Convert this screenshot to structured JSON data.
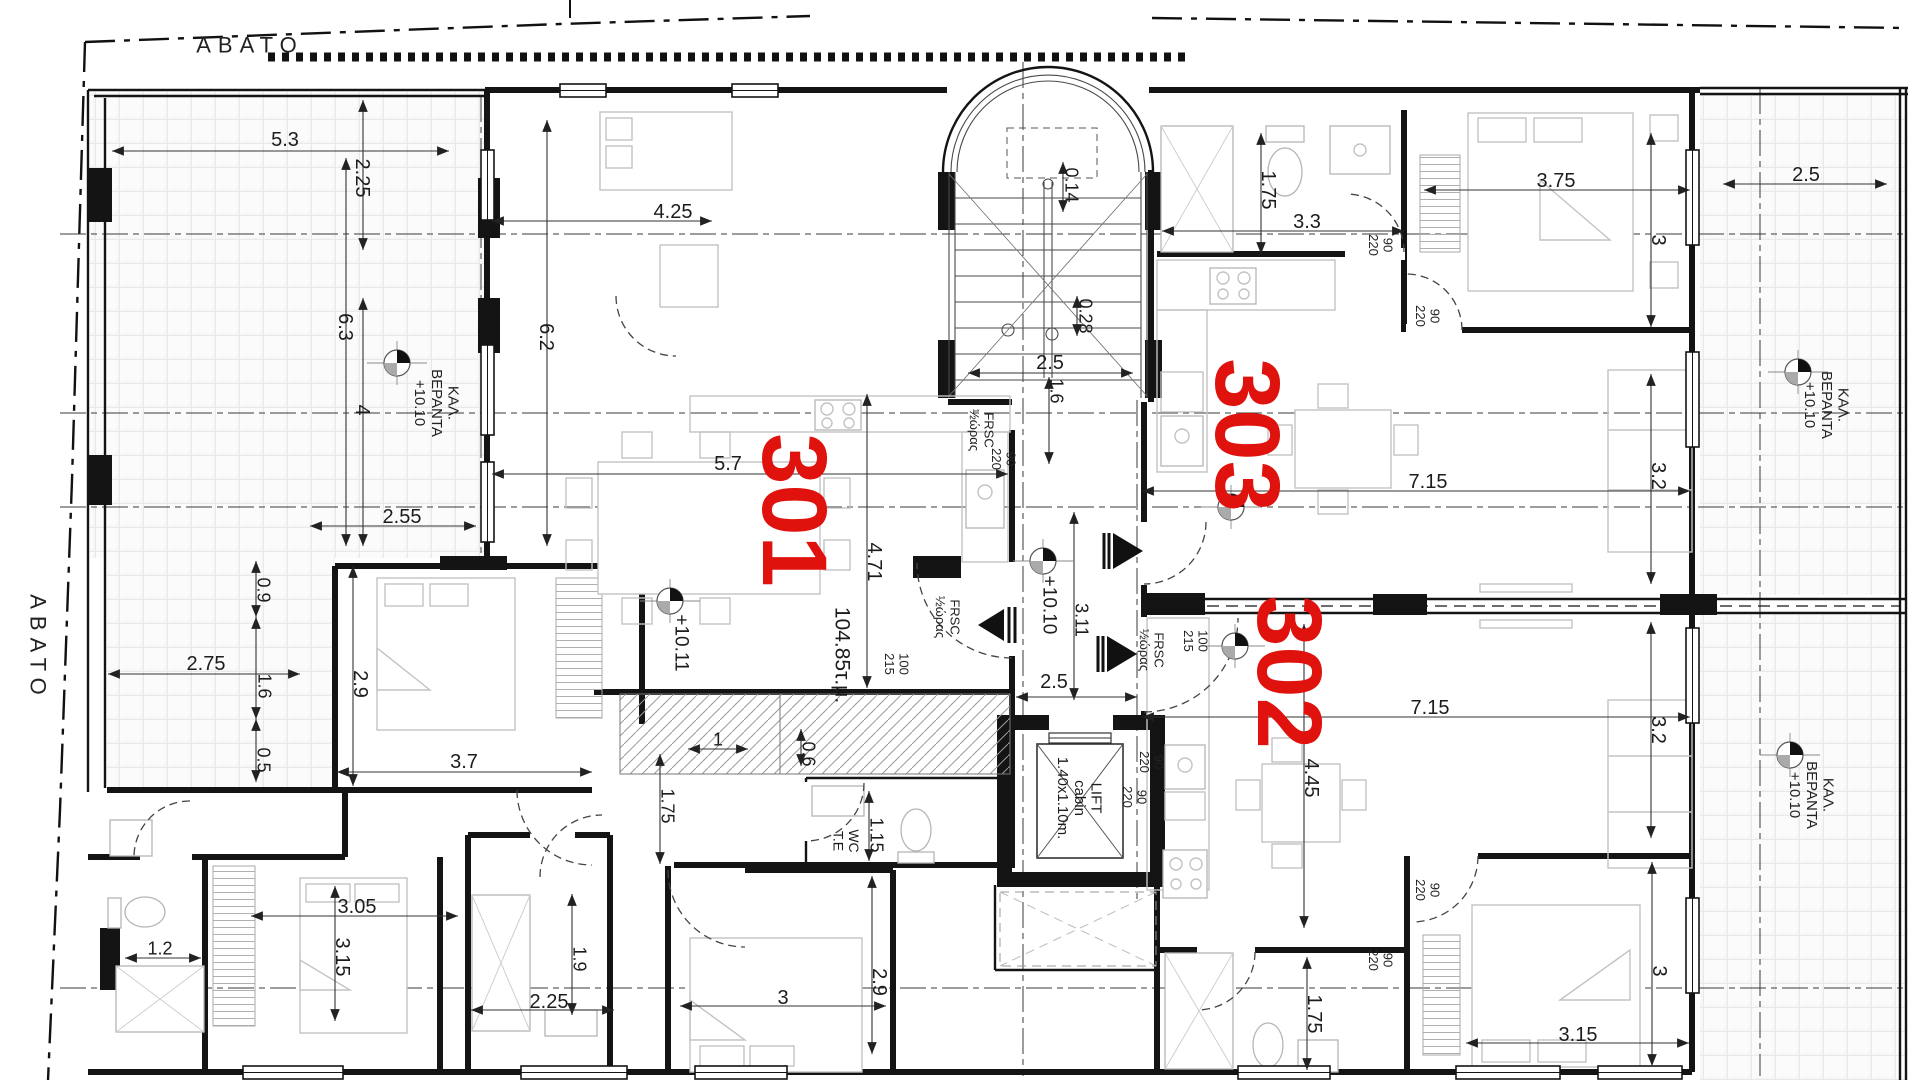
{
  "drawing": {
    "type": "architectural-floor-plan",
    "floor_area_label": "104.85τ.μ.",
    "red_accent": "#e0120d",
    "apartments": [
      "301",
      "302",
      "303"
    ]
  },
  "labels": [
    {
      "name": "zone-avato-top",
      "text": "ΑΒΑΤΟ",
      "x": 250,
      "y": 45,
      "rot": 0,
      "size": 22,
      "cls": "zone"
    },
    {
      "name": "zone-avato-left",
      "text": "ΑΒΑΤΟ",
      "x": 38,
      "y": 648,
      "rot": 90,
      "size": 22,
      "cls": "zone"
    },
    {
      "name": "veranda-label-left",
      "text": "ΚΑΛ.\nΒΕΡΑΝΤΑ\n+10.10",
      "x": 437,
      "y": 403,
      "rot": 90,
      "size": 15,
      "cls": "ver"
    },
    {
      "name": "veranda-label-top-right",
      "text": "ΚΑΛ.\nΒΕΡΑΝΤΑ\n+10.10",
      "x": 1827,
      "y": 405,
      "rot": 90,
      "size": 15,
      "cls": "ver"
    },
    {
      "name": "veranda-label-bottom-right",
      "text": "ΚΑΛ.\nΒΕΡΑΝΤΑ\n+10.10",
      "x": 1812,
      "y": 795,
      "rot": 90,
      "size": 15,
      "cls": "ver"
    },
    {
      "name": "lift-label",
      "text": "LIFT\ncabin\n1.40x1.10m.",
      "x": 1080,
      "y": 798,
      "rot": 90,
      "size": 15
    },
    {
      "name": "wc-label",
      "text": "WC\nT.E",
      "x": 846,
      "y": 841,
      "rot": 90,
      "size": 14
    },
    {
      "name": "area-label",
      "text": "104.85τ.μ.",
      "x": 843,
      "y": 655,
      "rot": 90,
      "size": 21
    },
    {
      "name": "level-1011",
      "text": "+10.11",
      "x": 682,
      "y": 643,
      "rot": 90,
      "size": 19
    },
    {
      "name": "level-1010",
      "text": "+10.10",
      "x": 1050,
      "y": 605,
      "rot": 90,
      "size": 19
    },
    {
      "name": "apartment-number-301",
      "text": "301",
      "x": 795,
      "y": 510,
      "rot": 90,
      "size": 92,
      "cls": "red"
    },
    {
      "name": "apartment-number-303",
      "text": "303",
      "x": 1248,
      "y": 435,
      "rot": 90,
      "size": 92,
      "cls": "red"
    },
    {
      "name": "apartment-number-302",
      "text": "302",
      "x": 1290,
      "y": 672,
      "rot": 90,
      "size": 92,
      "cls": "red"
    },
    {
      "name": "door-frsc-1",
      "text": "FRSC\n½ώρας",
      "x": 982,
      "y": 430,
      "rot": 90,
      "size": 13,
      "cls": "door"
    },
    {
      "name": "door-90-220-1",
      "text": "90\n220",
      "x": 1004,
      "y": 459,
      "rot": 90,
      "size": 13,
      "cls": "door"
    },
    {
      "name": "door-frsc-2",
      "text": "FRSC\n½ώρας",
      "x": 948,
      "y": 617,
      "rot": 90,
      "size": 13,
      "cls": "door"
    },
    {
      "name": "door-100-215-1",
      "text": "100\n215",
      "x": 897,
      "y": 664,
      "rot": 90,
      "size": 13,
      "cls": "door"
    },
    {
      "name": "door-frsc-3",
      "text": "FRSC\n½ώρας",
      "x": 1152,
      "y": 650,
      "rot": 90,
      "size": 13,
      "cls": "door"
    },
    {
      "name": "door-100-215-2",
      "text": "100\n215",
      "x": 1196,
      "y": 641,
      "rot": 90,
      "size": 13,
      "cls": "door"
    },
    {
      "name": "door-90-220-2",
      "text": "90\n220",
      "x": 1381,
      "y": 245,
      "rot": 90,
      "size": 13,
      "cls": "door"
    },
    {
      "name": "door-90-220-3",
      "text": "90\n220",
      "x": 1428,
      "y": 316,
      "rot": 90,
      "size": 13,
      "cls": "door"
    },
    {
      "name": "door-90-220-4",
      "text": "90\n220",
      "x": 1152,
      "y": 762,
      "rot": 90,
      "size": 13,
      "cls": "door"
    },
    {
      "name": "door-90-220-5",
      "text": "90\n220",
      "x": 1135,
      "y": 797,
      "rot": 90,
      "size": 13,
      "cls": "door"
    },
    {
      "name": "door-90-220-6",
      "text": "90\n220",
      "x": 1428,
      "y": 890,
      "rot": 90,
      "size": 13,
      "cls": "door"
    },
    {
      "name": "door-90-220-7",
      "text": "90\n220",
      "x": 1381,
      "y": 960,
      "rot": 90,
      "size": 13,
      "cls": "door"
    },
    {
      "name": "dim-5-3",
      "text": "5.3",
      "x": 285,
      "y": 139,
      "rot": 0,
      "size": 20,
      "line": [
        112,
        151,
        449,
        151
      ]
    },
    {
      "name": "dim-2-25",
      "text": "2.25",
      "x": 363,
      "y": 178,
      "rot": 90,
      "size": 20,
      "line": [
        363,
        100,
        363,
        250
      ]
    },
    {
      "name": "dim-6-3",
      "text": "6.3",
      "x": 346,
      "y": 327,
      "rot": 90,
      "size": 20,
      "line": [
        346,
        158,
        346,
        546
      ]
    },
    {
      "name": "dim-4",
      "text": "4",
      "x": 363,
      "y": 410,
      "rot": 90,
      "size": 20,
      "line": [
        363,
        298,
        363,
        546
      ]
    },
    {
      "name": "dim-4-25",
      "text": "4.25",
      "x": 673,
      "y": 211,
      "rot": 0,
      "size": 20,
      "line": [
        492,
        221,
        712,
        221
      ]
    },
    {
      "name": "dim-6-2",
      "text": "6.2",
      "x": 547,
      "y": 337,
      "rot": 90,
      "size": 20,
      "line": [
        547,
        120,
        547,
        546
      ]
    },
    {
      "name": "dim-2-55",
      "text": "2.55",
      "x": 402,
      "y": 516,
      "rot": 0,
      "size": 20,
      "line": [
        310,
        526,
        476,
        526
      ]
    },
    {
      "name": "dim-5-7",
      "text": "5.7",
      "x": 728,
      "y": 463,
      "rot": 0,
      "size": 20,
      "line": [
        492,
        474,
        1008,
        474
      ]
    },
    {
      "name": "dim-0-14",
      "text": "0.14",
      "x": 1072,
      "y": 185,
      "rot": 90,
      "size": 18,
      "line": [
        1063,
        162,
        1063,
        212
      ]
    },
    {
      "name": "dim-0-28",
      "text": "0.28",
      "x": 1086,
      "y": 316,
      "rot": 90,
      "size": 18,
      "line": [
        1077,
        296,
        1077,
        336
      ]
    },
    {
      "name": "dim-2-5-stair",
      "text": "2.5",
      "x": 1050,
      "y": 362,
      "rot": 0,
      "size": 20,
      "line": [
        968,
        373,
        1133,
        373
      ]
    },
    {
      "name": "dim-1-6-stair",
      "text": "1.6",
      "x": 1057,
      "y": 391,
      "rot": 90,
      "size": 18,
      "line": [
        1049,
        377,
        1049,
        464
      ]
    },
    {
      "name": "dim-1-75-tr",
      "text": "1.75",
      "x": 1269,
      "y": 190,
      "rot": 90,
      "size": 20,
      "line": [
        1261,
        133,
        1261,
        254
      ]
    },
    {
      "name": "dim-3-3",
      "text": "3.3",
      "x": 1307,
      "y": 221,
      "rot": 0,
      "size": 20,
      "line": [
        1162,
        231,
        1404,
        231
      ]
    },
    {
      "name": "dim-3-75",
      "text": "3.75",
      "x": 1556,
      "y": 180,
      "rot": 0,
      "size": 20,
      "line": [
        1424,
        190,
        1690,
        190
      ]
    },
    {
      "name": "dim-3-tr",
      "text": "3",
      "x": 1659,
      "y": 240,
      "rot": 90,
      "size": 20,
      "line": [
        1651,
        133,
        1651,
        327
      ]
    },
    {
      "name": "dim-2-5-tr",
      "text": "2.5",
      "x": 1806,
      "y": 174,
      "rot": 0,
      "size": 20,
      "line": [
        1723,
        184,
        1887,
        184
      ]
    },
    {
      "name": "dim-7-15-upper",
      "text": "7.15",
      "x": 1428,
      "y": 481,
      "rot": 0,
      "size": 20,
      "line": [
        1142,
        491,
        1690,
        491
      ]
    },
    {
      "name": "dim-3-2-upper",
      "text": "3.2",
      "x": 1659,
      "y": 476,
      "rot": 90,
      "size": 20,
      "line": [
        1651,
        374,
        1651,
        584
      ]
    },
    {
      "name": "dim-7-15-lower",
      "text": "7.15",
      "x": 1430,
      "y": 707,
      "rot": 0,
      "size": 20,
      "line": [
        1142,
        717,
        1690,
        717
      ]
    },
    {
      "name": "dim-3-2-lower",
      "text": "3.2",
      "x": 1659,
      "y": 730,
      "rot": 90,
      "size": 20,
      "line": [
        1651,
        622,
        1651,
        838
      ]
    },
    {
      "name": "dim-4-71",
      "text": "4.71",
      "x": 875,
      "y": 562,
      "rot": 90,
      "size": 20,
      "line": [
        867,
        394,
        867,
        688
      ]
    },
    {
      "name": "dim-3-11",
      "text": "3.11",
      "x": 1082,
      "y": 620,
      "rot": 90,
      "size": 18,
      "line": [
        1074,
        512,
        1074,
        700
      ]
    },
    {
      "name": "dim-2-5-corr",
      "text": "2.5",
      "x": 1054,
      "y": 681,
      "rot": 0,
      "size": 20,
      "line": [
        1016,
        697,
        1137,
        697
      ]
    },
    {
      "name": "dim-2-75",
      "text": "2.75",
      "x": 206,
      "y": 663,
      "rot": 0,
      "size": 20,
      "line": [
        108,
        674,
        300,
        674
      ]
    },
    {
      "name": "dim-0-9",
      "text": "0.9",
      "x": 264,
      "y": 590,
      "rot": 90,
      "size": 18,
      "line": [
        256,
        561,
        256,
        617
      ]
    },
    {
      "name": "dim-1-6-left",
      "text": "1.6",
      "x": 265,
      "y": 686,
      "rot": 90,
      "size": 18,
      "line": [
        256,
        617,
        256,
        719
      ]
    },
    {
      "name": "dim-0-5",
      "text": "0.5",
      "x": 264,
      "y": 760,
      "rot": 90,
      "size": 18,
      "line": [
        256,
        719,
        256,
        782
      ]
    },
    {
      "name": "dim-2-9-bed",
      "text": "2.9",
      "x": 361,
      "y": 684,
      "rot": 90,
      "size": 20,
      "line": [
        353,
        566,
        353,
        786
      ]
    },
    {
      "name": "dim-3-7",
      "text": "3.7",
      "x": 464,
      "y": 761,
      "rot": 0,
      "size": 20,
      "line": [
        337,
        772,
        592,
        772
      ]
    },
    {
      "name": "dim-1",
      "text": "1",
      "x": 718,
      "y": 739,
      "rot": 0,
      "size": 18,
      "line": [
        688,
        749,
        748,
        749
      ]
    },
    {
      "name": "dim-0-6",
      "text": "0.6",
      "x": 809,
      "y": 754,
      "rot": 90,
      "size": 18,
      "line": [
        801,
        729,
        801,
        766
      ]
    },
    {
      "name": "dim-1-75-hall",
      "text": "1.75",
      "x": 668,
      "y": 806,
      "rot": 90,
      "size": 18,
      "line": [
        660,
        754,
        660,
        864
      ]
    },
    {
      "name": "dim-1-15",
      "text": "1.15",
      "x": 877,
      "y": 835,
      "rot": 90,
      "size": 18,
      "line": [
        869,
        791,
        869,
        861
      ]
    },
    {
      "name": "dim-3-05",
      "text": "3.05",
      "x": 357,
      "y": 906,
      "rot": 0,
      "size": 20,
      "line": [
        251,
        916,
        458,
        916
      ]
    },
    {
      "name": "dim-1-2",
      "text": "1.2",
      "x": 160,
      "y": 948,
      "rot": 0,
      "size": 18,
      "line": [
        125,
        958,
        201,
        958
      ]
    },
    {
      "name": "dim-3-15-left",
      "text": "3.15",
      "x": 343,
      "y": 957,
      "rot": 90,
      "size": 20,
      "line": [
        335,
        886,
        335,
        1021
      ]
    },
    {
      "name": "dim-1-9",
      "text": "1.9",
      "x": 580,
      "y": 959,
      "rot": 90,
      "size": 18,
      "line": [
        572,
        894,
        572,
        1015
      ]
    },
    {
      "name": "dim-2-25-b",
      "text": "2.25",
      "x": 549,
      "y": 1001,
      "rot": 0,
      "size": 20,
      "line": [
        471,
        1010,
        614,
        1010
      ]
    },
    {
      "name": "dim-3-b",
      "text": "3",
      "x": 783,
      "y": 997,
      "rot": 0,
      "size": 20,
      "line": [
        680,
        1006,
        886,
        1006
      ]
    },
    {
      "name": "dim-2-9-b",
      "text": "2.9",
      "x": 880,
      "y": 982,
      "rot": 90,
      "size": 20,
      "line": [
        872,
        876,
        872,
        1054
      ]
    },
    {
      "name": "dim-4-45",
      "text": "4.45",
      "x": 1312,
      "y": 778,
      "rot": 90,
      "size": 20,
      "line": [
        1304,
        624,
        1304,
        928
      ]
    },
    {
      "name": "dim-1-75-br",
      "text": "1.75",
      "x": 1315,
      "y": 1014,
      "rot": 90,
      "size": 20,
      "line": [
        1307,
        957,
        1307,
        1070
      ]
    },
    {
      "name": "dim-3-br",
      "text": "3",
      "x": 1660,
      "y": 971,
      "rot": 90,
      "size": 20,
      "line": [
        1652,
        862,
        1652,
        1066
      ]
    },
    {
      "name": "dim-3-15-br",
      "text": "3.15",
      "x": 1578,
      "y": 1034,
      "rot": 0,
      "size": 20,
      "line": [
        1466,
        1043,
        1689,
        1043
      ]
    }
  ]
}
